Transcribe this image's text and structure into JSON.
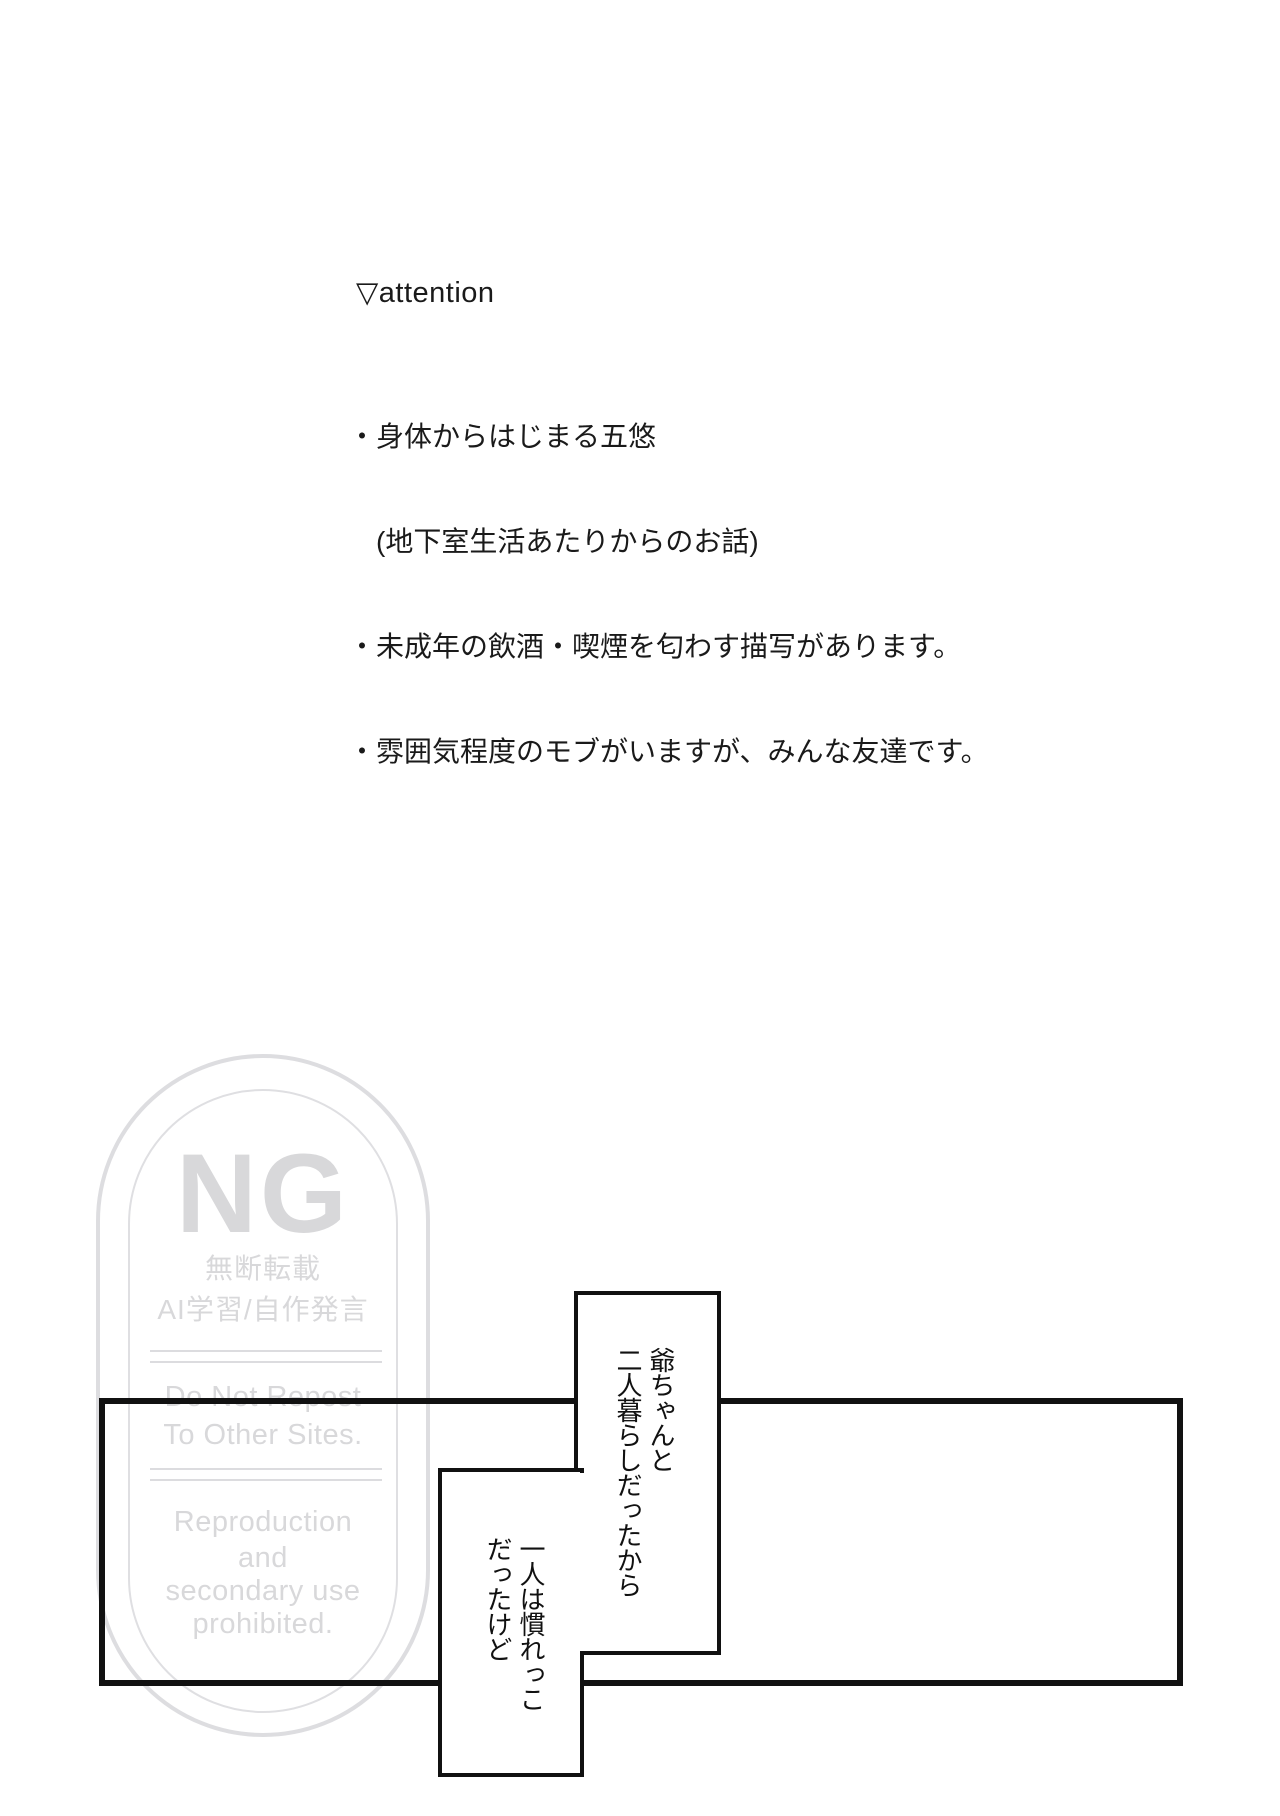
{
  "attention": {
    "title": "▽attention",
    "lines": [
      "・身体からはじまる五悠",
      "　(地下室生活あたりからのお話)",
      "・未成年の飲酒・喫煙を匂わす描写があります。",
      "・雰囲気程度のモブがいますが、みんな友達です。"
    ]
  },
  "watermark": {
    "ng": "NG",
    "jp_line1": "無断転載",
    "jp_line2": "AI学習/自作発言",
    "en_line1": "Do Not Repost",
    "en_line2": "To Other Sites.",
    "en_line3": "Reproduction",
    "en_line4": "and",
    "en_line5": "secondary use",
    "en_line6": "prohibited."
  },
  "manga": {
    "bubble1": {
      "line1": "爺ちゃんと",
      "line2": "二人暮らしだったから"
    },
    "bubble2": {
      "line1": "一人は慣れっこ",
      "line2": "だったけど"
    }
  },
  "colors": {
    "ink": "#111111",
    "text": "#1a1a1a",
    "watermark_gray": "#d8d8da",
    "background": "#ffffff"
  }
}
